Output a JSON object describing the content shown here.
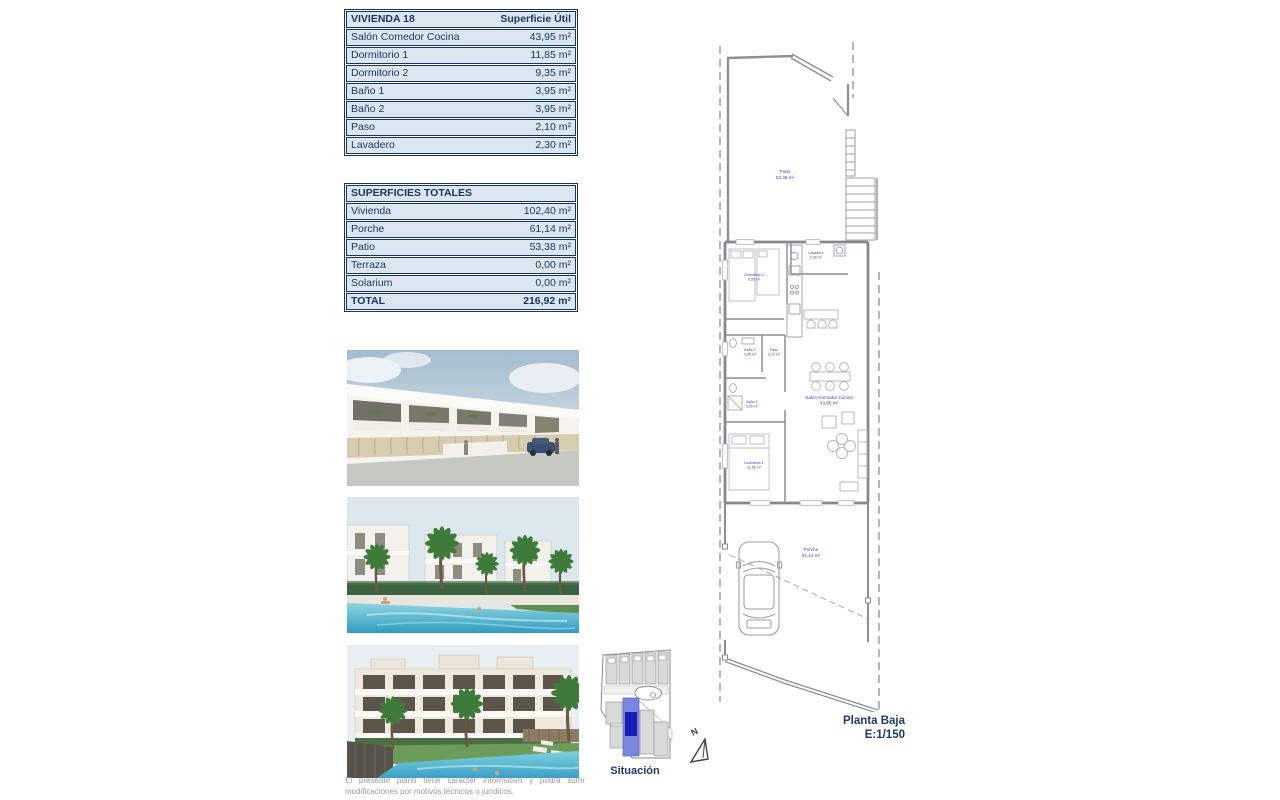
{
  "tables": {
    "vivienda": {
      "title": "VIVIENDA 18",
      "header_right": "Superficie Útil",
      "rows": [
        {
          "label": "Salón Comedor Cocina",
          "value": "43,95 m²"
        },
        {
          "label": "Dormitorio 1",
          "value": "11,85 m²"
        },
        {
          "label": "Dormitorio 2",
          "value": "9,35 m²"
        },
        {
          "label": "Baño 1",
          "value": "3,95 m²"
        },
        {
          "label": "Baño 2",
          "value": "3,95 m²"
        },
        {
          "label": "Paso",
          "value": "2,10 m²"
        },
        {
          "label": "Lavadero",
          "value": "2,30 m²"
        }
      ]
    },
    "totales": {
      "title": "SUPERFICIES TOTALES",
      "rows": [
        {
          "label": "Vivienda",
          "value": "102,40 m²"
        },
        {
          "label": "Porche",
          "value": "61,14 m²"
        },
        {
          "label": "Patio",
          "value": "53,38 m²"
        },
        {
          "label": "Terraza",
          "value": "0,00 m²"
        },
        {
          "label": "Solarium",
          "value": "0,00 m²"
        }
      ],
      "total": {
        "label": "TOTAL",
        "value": "216,92 m²"
      }
    }
  },
  "plan": {
    "title": "Planta Baja",
    "scale": "E:1/150",
    "rooms": {
      "patio": {
        "name": "Patio",
        "area": "53,38 m²"
      },
      "lavadero": {
        "name": "Lavadero",
        "area": "2,30 m²"
      },
      "dormitorio2": {
        "name": "Dormitorio 2",
        "area": "9,35 m²"
      },
      "bano2": {
        "name": "Baño 2",
        "area": "3,95 m²"
      },
      "paso": {
        "name": "Paso",
        "area": "2,10 m²"
      },
      "bano1": {
        "name": "Baño 1",
        "area": "3,95 m²"
      },
      "salon": {
        "name": "Salón Comedor Cocina",
        "area": "43,95 m²"
      },
      "dormitorio1": {
        "name": "Dormitorio 1",
        "area": "11,85 m²"
      },
      "porche": {
        "name": "Porche",
        "area": "61,14 m²"
      }
    }
  },
  "situacion": {
    "label": "Situación",
    "north": "N"
  },
  "disclaimer": "El presente plano tiene carácter informativo y podrá sufrir modificaciones por motivos técnicos o jurídicos.",
  "colors": {
    "table_bg": "#dce6f1",
    "table_text": "#17365d",
    "plan_label_blue": "#3c3cb4",
    "highlight_plot": "#1b1bb8"
  }
}
